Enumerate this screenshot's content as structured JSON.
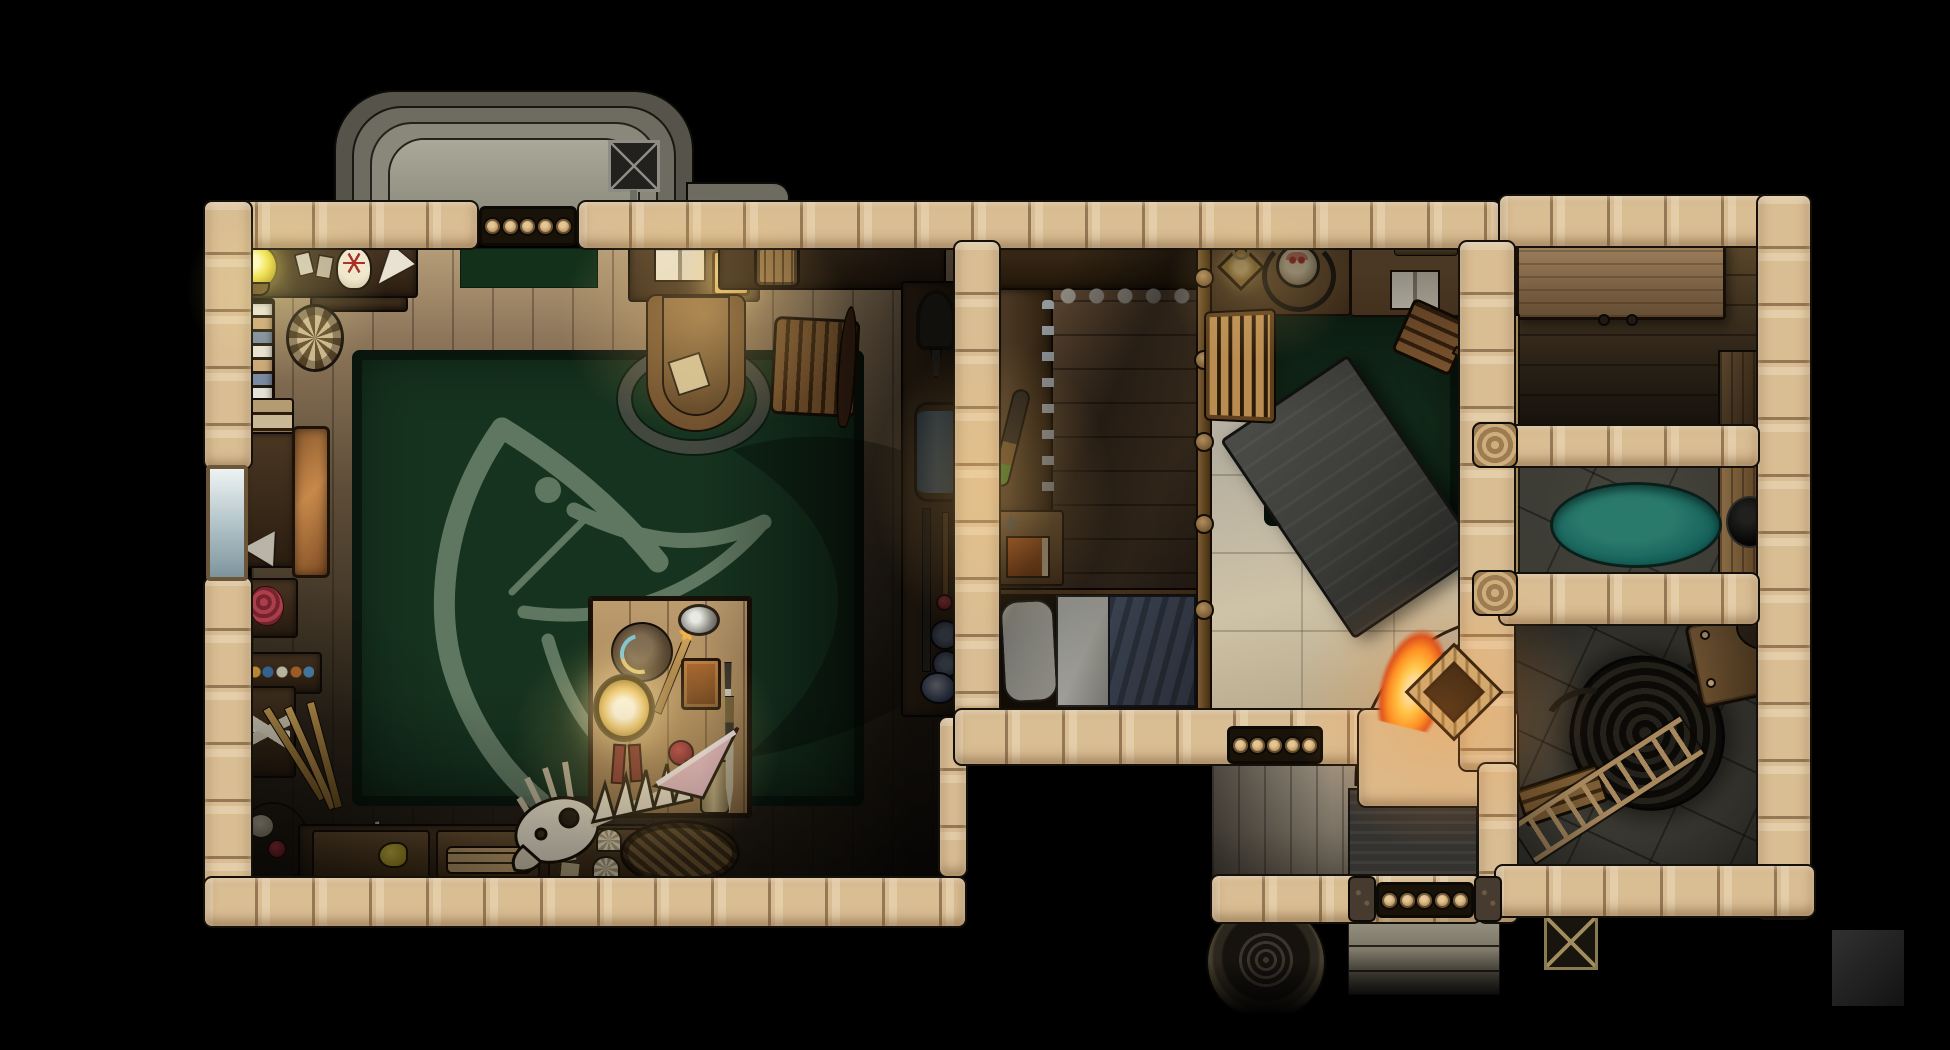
{
  "scene": {
    "kind": "top-down fantasy battlemap",
    "subject": "witch's cottage interior at night, stone-walled building on black background",
    "rooms": [
      "study-with-raven-rug",
      "workshop-bedroom",
      "hearth-room",
      "storage-room",
      "wash-room",
      "dark-cellar-room",
      "entry-porch"
    ],
    "props": [
      "crystal-ball",
      "spell-cards",
      "pentagram-skull",
      "ivory-cone",
      "bookshelf",
      "scroll-rosette",
      "writing-desk",
      "open-book",
      "desk-lamp",
      "round-desk-chair",
      "ladder-back-chair",
      "dried-flower-shelf",
      "keg",
      "tool-rack",
      "bellows",
      "bedroll",
      "spear",
      "red-knob-staff",
      "talisman-discs",
      "pouch",
      "gear-workbench",
      "funnel",
      "copper-trunk",
      "entrails-tray",
      "potion-shelf",
      "bone-crate",
      "brooms",
      "nest-with-skull",
      "curved-horn",
      "storage-cabinets",
      "duck-figurine",
      "log-bundle",
      "witch-table",
      "witch-hat",
      "star-wand",
      "hand-mirror",
      "trinket-box",
      "dagger",
      "glowing-lamp",
      "sword",
      "scroll",
      "pomegranate",
      "fish-skeleton",
      "seashells",
      "woven-basket",
      "raven-emblem-rug",
      "bottle-workbench",
      "club",
      "nightstand",
      "orange-book",
      "bed",
      "pillow",
      "blanket",
      "divider-rail",
      "crib-gate",
      "diamond-lantern",
      "hanging-cauldron",
      "counter-open-book",
      "fallen-chair",
      "charcoal-table",
      "green-mat",
      "fireplace-hearth",
      "fire",
      "firewood-stack",
      "wall-ladders",
      "big-storage-table",
      "wash-pool",
      "black-cauldron",
      "side-bench",
      "rope-coil",
      "ladder",
      "stool",
      "small-bench",
      "doormat",
      "entry-steps",
      "round-well",
      "weathervane",
      "root-cellar-roof",
      "log-windows",
      "glass-window"
    ]
  },
  "colors": {
    "background": "#000000",
    "wall": "#d9bd93",
    "rug_green": "#16331f",
    "rug_emblem": "#8da289",
    "pool_teal": "#15615a",
    "charcoal_table": "#3c3c39",
    "blanket_blue": "#4a5466",
    "doormat": "#35332f",
    "fire_orange": "#ff8c1e",
    "fire_core": "#ffefb0",
    "glow_warm": "#ffcf7a",
    "stone_floor": "#bfb9a9",
    "dark_stone_floor": "#3d3c35",
    "porch_wood": "#8f8677",
    "study_wood": "#8d765a",
    "teal_pool_outline": "#0a1f1a"
  }
}
